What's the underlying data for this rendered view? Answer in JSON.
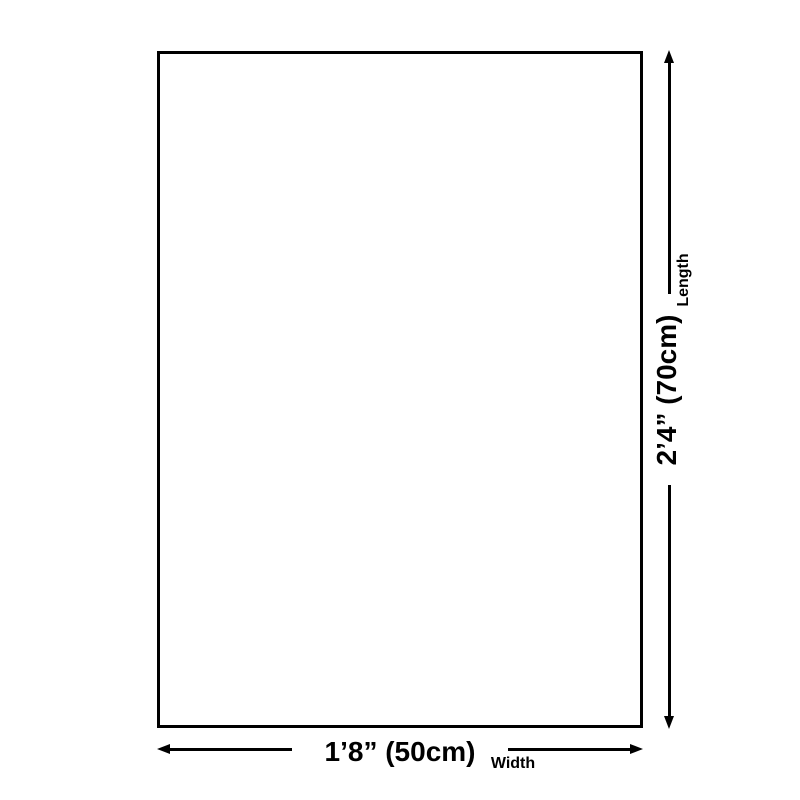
{
  "diagram": {
    "background_color": "#ffffff",
    "ink_color": "#000000",
    "length_dimension": {
      "value": "2’4” (70cm)",
      "label": "Length"
    },
    "width_dimension": {
      "value": "1’8” (50cm)",
      "label": "Width"
    }
  }
}
